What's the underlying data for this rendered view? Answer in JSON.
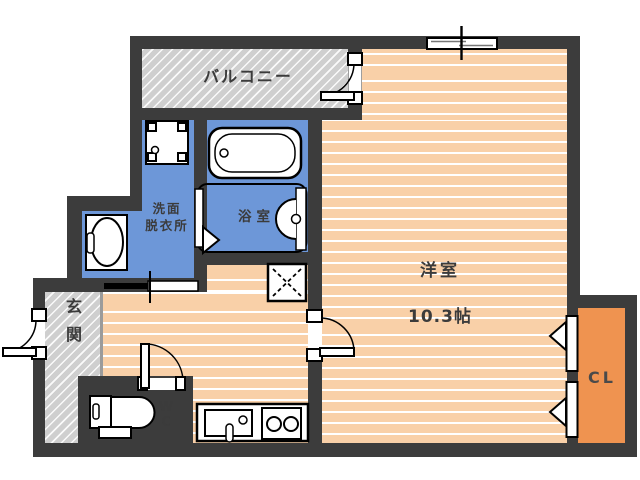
{
  "plan": {
    "labels": {
      "balcony": "バルコニー",
      "room": "洋室",
      "room_size": "10.3帖",
      "washroom": "洗面\n脱衣所",
      "bath": "浴室",
      "entrance": "玄\n関",
      "wc": "W\nC",
      "closet": "CL"
    },
    "colors": {
      "wall": "#3c3c3c",
      "flooring": "#f9d0a8",
      "wet_area": "#6d97d8",
      "closet": "#ef9350",
      "hatch_gray": "#cfcfcf",
      "label_text": "#3b3b3b"
    },
    "fixtures": {
      "bathtub": "bathtub-icon",
      "washing_machine_pan": "washing-machine-pan-icon",
      "washbasin": "washbasin-icon",
      "bathroom_basin": "bathroom-basin-icon",
      "toilet": "toilet-icon",
      "kitchen_sink": "kitchen-sink-icon",
      "stove": "two-burner-stove-icon",
      "window": "sliding-window-icon",
      "floor_hatch": "floor-hatch-icon"
    }
  }
}
